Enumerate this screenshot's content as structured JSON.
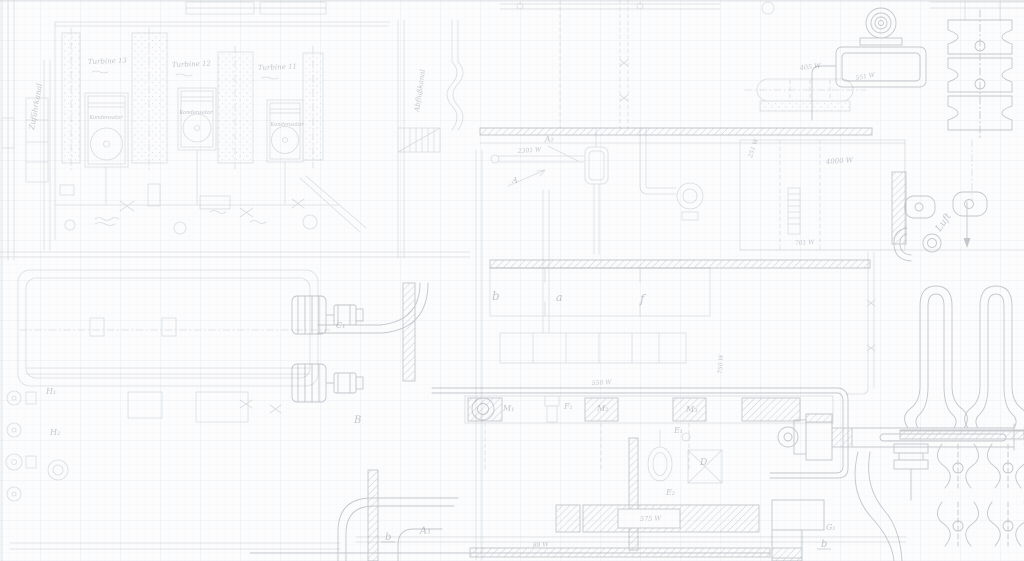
{
  "drawing": {
    "turbine_units": [
      {
        "name": "Turbine 13",
        "condenser_label": "Kondensator"
      },
      {
        "name": "Turbine 12",
        "condenser_label": "Kondensator"
      },
      {
        "name": "Turbine 11",
        "condenser_label": "Kondensator"
      }
    ],
    "channel_labels": {
      "supply": "Zuführkanal",
      "discharge": "Abflußkanal"
    },
    "air_flow_label": "Luft",
    "flow_values": {
      "main_supply": "2301 W",
      "condenser_top": "405 W",
      "condenser_top_right": "551 W",
      "intake_left": "251 W",
      "intake_main": "4000 W",
      "intake_bottom": "701 W",
      "pump_header": "550 W",
      "pump_riser": "750 W",
      "discharge_box": "575 W",
      "drain_line": "88 W"
    },
    "point_labels": {
      "a_cap": "A",
      "a1": "A₁",
      "a2": "A₂",
      "b_cap": "B",
      "c1": "C₁",
      "d": "D",
      "e1": "E₁",
      "e2": "E₂",
      "f1": "F₁",
      "g1": "G₁",
      "h1": "H₁",
      "h2": "H₂",
      "m1": "M₁",
      "m2": "M₂",
      "m3": "M₃",
      "basin_a": "a",
      "basin_b": "b",
      "basin_f": "f",
      "section_b": "b",
      "section_b2": "b"
    }
  },
  "palette": {
    "paper": "#fcfcfd",
    "ink_faint": "#dee0e4",
    "ink_medium": "#c7cad0",
    "grid": "#e9edf3"
  }
}
